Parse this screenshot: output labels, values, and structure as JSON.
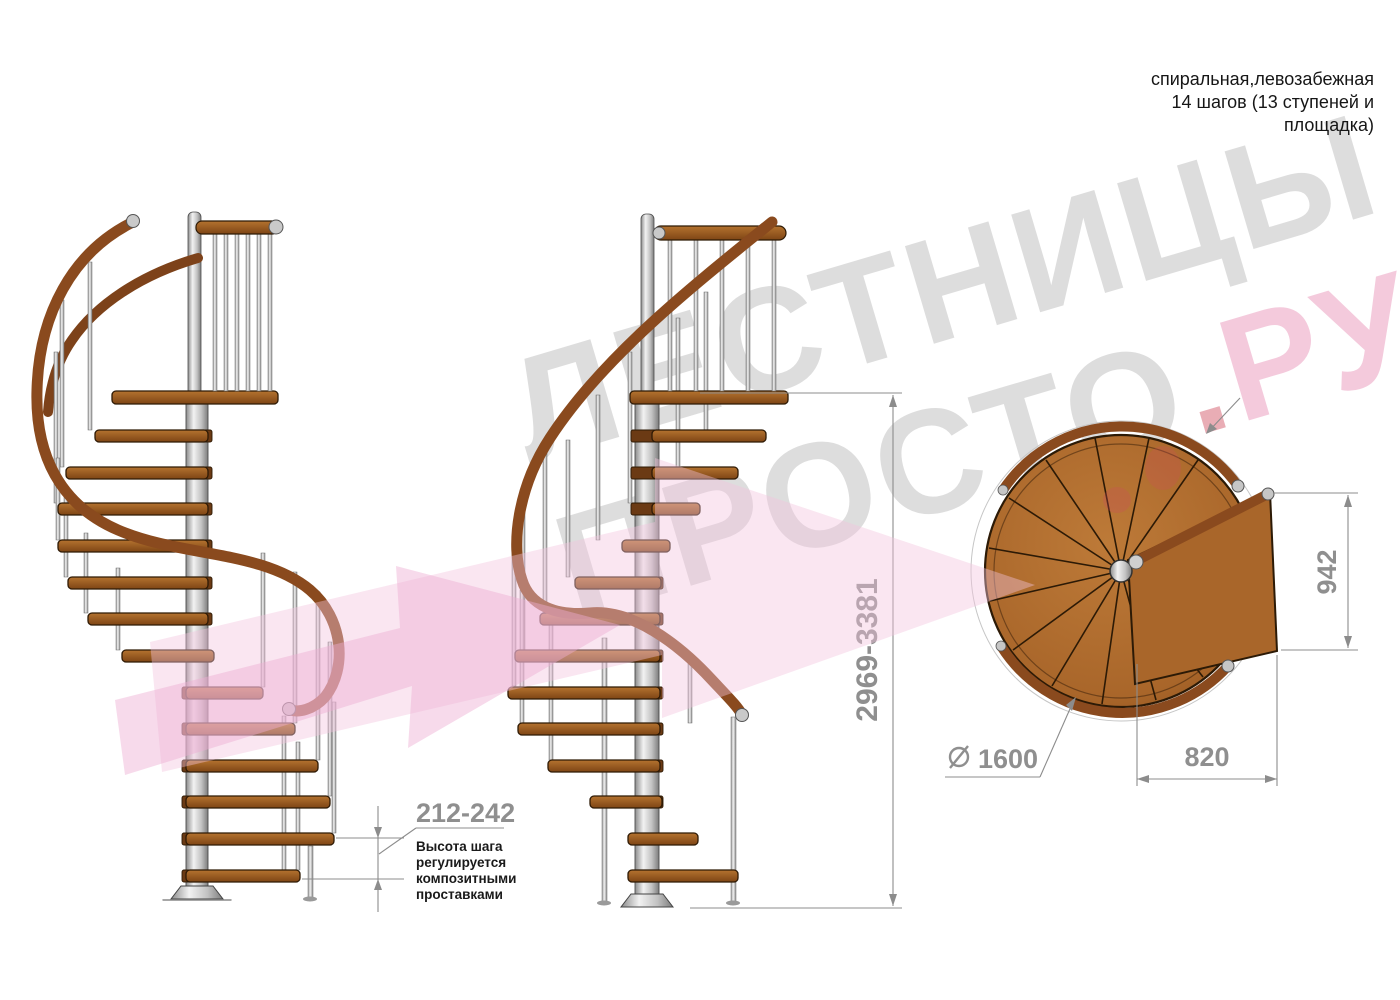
{
  "header": {
    "lines": [
      "спиральная,левозабежная",
      "14 шагов (13 ступеней и",
      "площадка)"
    ]
  },
  "watermark": {
    "line1": "ЛЕСТНИЦЫ",
    "line2": "ПРОСТО",
    "dot": ".",
    "suffix": "РУ"
  },
  "dims": {
    "total_height": "2969-3381",
    "step_height": "212-242",
    "note": [
      "Высота шага",
      "регулируется",
      "композитными",
      "проставками"
    ],
    "diameter_value": "1600",
    "landing_width": "820",
    "landing_depth": "942"
  },
  "colors": {
    "wood": "#ab6a2b",
    "wood_dark": "#7e4515",
    "handrail": "#8a4a1e",
    "metal": "#d6d6d6",
    "dimension_gray": "#8f8f8f",
    "watermark_gray": "rgba(55,55,55,0.17)",
    "watermark_pink": "#e996ba",
    "watermark_red": "#ce4a5c",
    "arrow_pink": "#f2c4de"
  }
}
